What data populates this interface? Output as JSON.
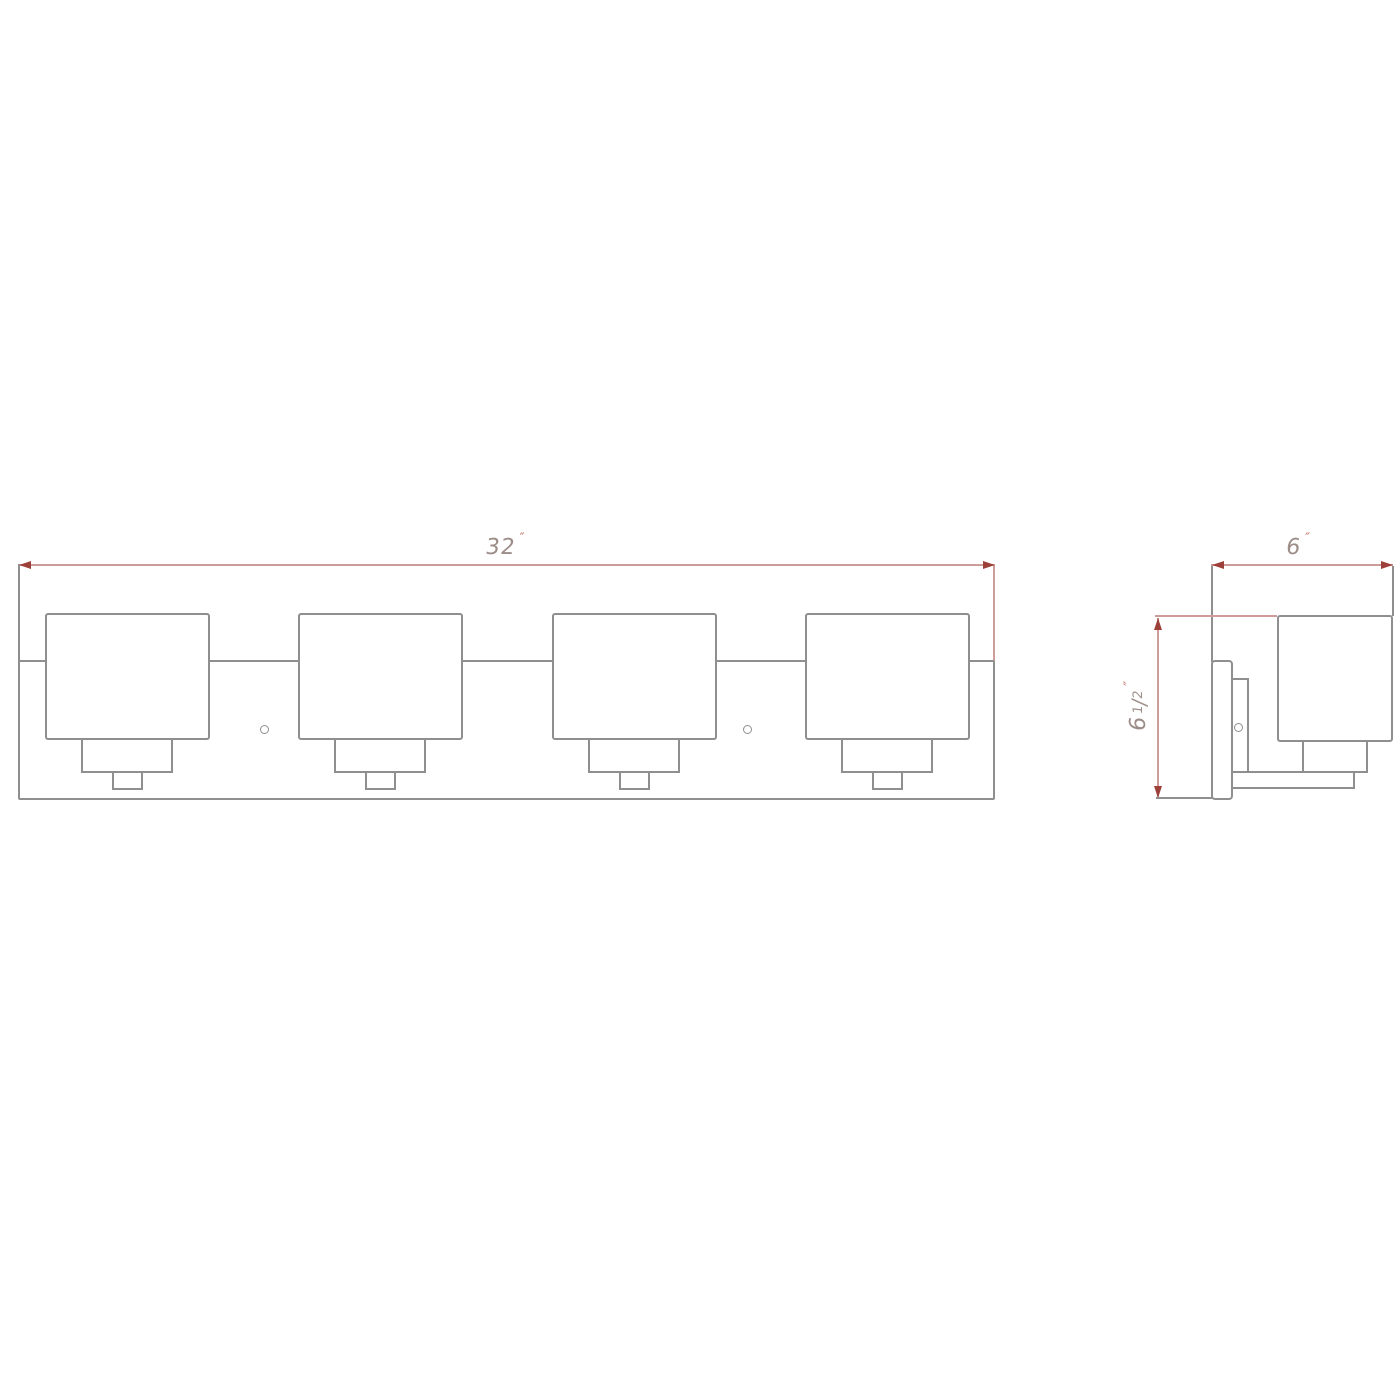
{
  "drawing": {
    "front_view": {
      "width_dimension": {
        "value": "32",
        "unit": "″"
      },
      "shade_count": 4,
      "mounting_hole_count": 2
    },
    "side_view": {
      "depth_dimension": {
        "value": "6",
        "unit": "″"
      },
      "height_dimension": {
        "whole": "6",
        "numerator": "1",
        "slash": "/",
        "denominator": "2",
        "unit": "″"
      }
    }
  },
  "colors": {
    "background": "#ffffff",
    "object_line": "#8f8f8f",
    "dim_line": "#cf9d99",
    "dim_arrow": "#9e403a",
    "dim_text": "#9c8d88",
    "unit_mark": "#bf6b60"
  }
}
